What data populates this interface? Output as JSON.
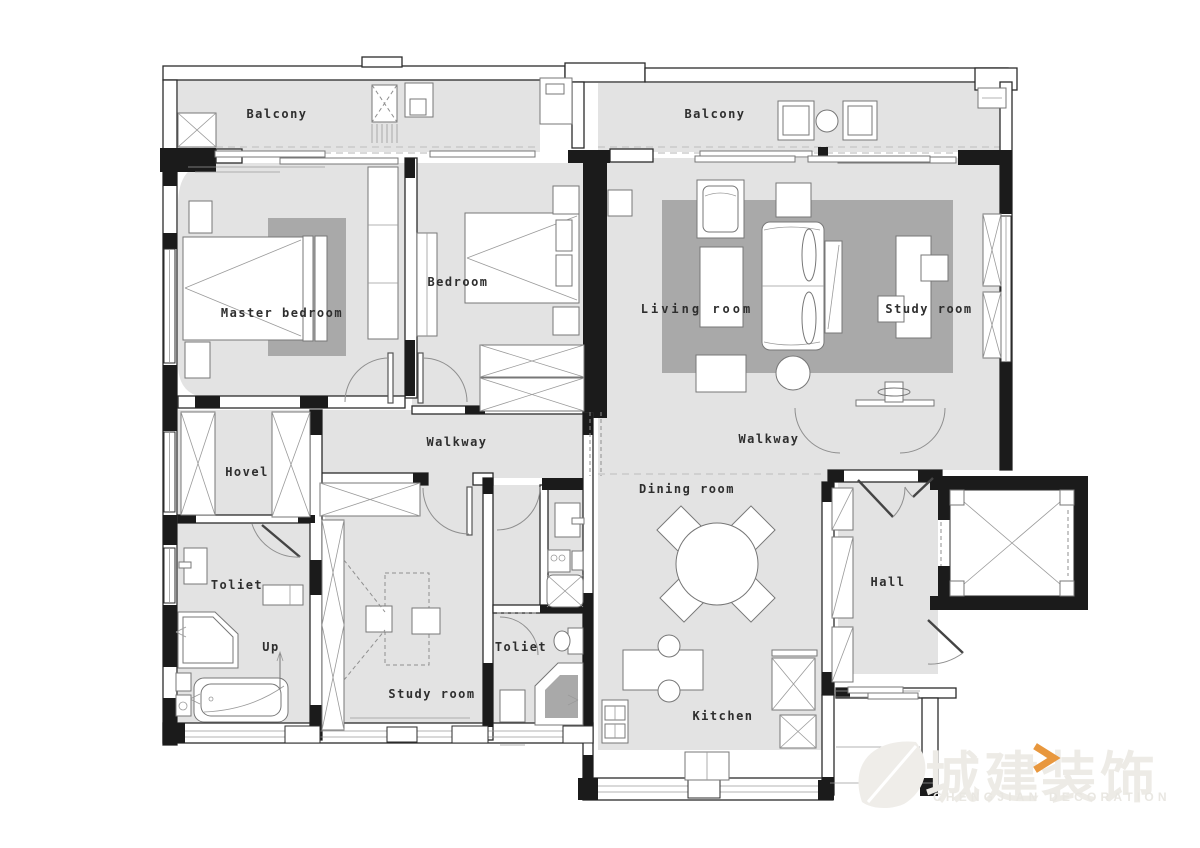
{
  "plan": {
    "rooms": [
      {
        "label": "Balcony"
      },
      {
        "label": "Balcony"
      },
      {
        "label": "Master bedroom"
      },
      {
        "label": "Bedroom"
      },
      {
        "label": "Living room"
      },
      {
        "label": "Study room"
      },
      {
        "label": "Walkway"
      },
      {
        "label": "Walkway"
      },
      {
        "label": "Hovel"
      },
      {
        "label": "Toliet"
      },
      {
        "label": "Up"
      },
      {
        "label": "Study room"
      },
      {
        "label": "Toliet"
      },
      {
        "label": "Dining room"
      },
      {
        "label": "Hall"
      },
      {
        "label": "Kitchen"
      }
    ],
    "colors": {
      "floor": "#e3e3e3",
      "rug": "#a9a9a9",
      "wall": "#1b1b1b",
      "accent": "#e8973d"
    },
    "watermark": {
      "brand_left": "城建",
      "brand_right": "装饰",
      "tagline": "CHENGJIAN DECORATION"
    }
  }
}
